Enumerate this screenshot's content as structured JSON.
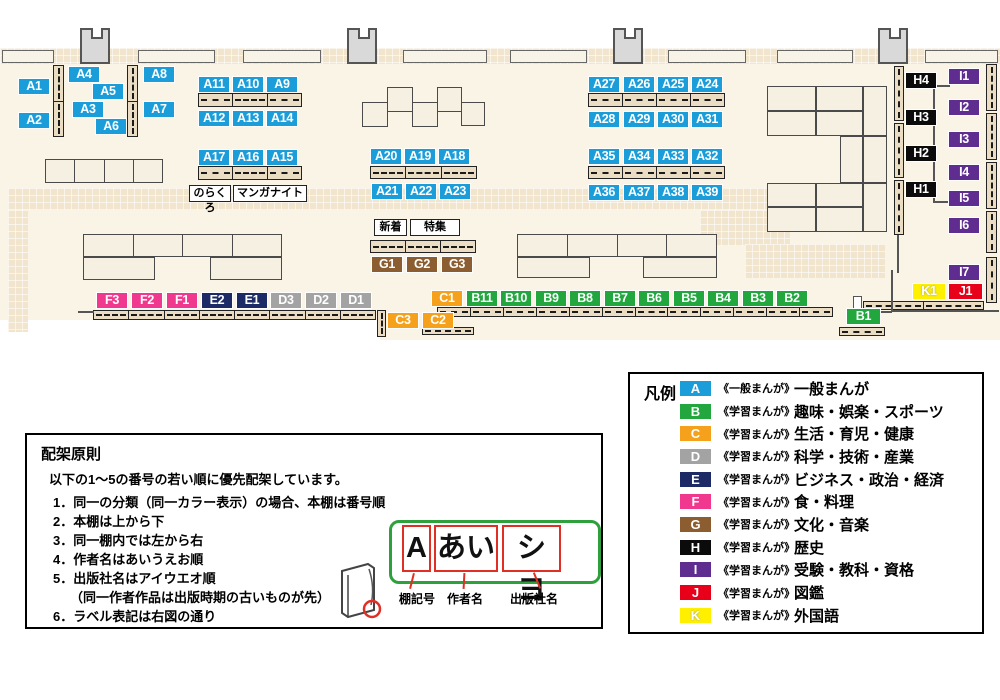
{
  "map": {
    "label_colors": {
      "A": "#1B9DD9",
      "B": "#21A73E",
      "C": "#F5A11C",
      "D": "#A3A3A3",
      "E": "#1C2A65",
      "F": "#F0388E",
      "G": "#8B5D30",
      "H": "#0B0B0B",
      "I": "#5F2C90",
      "J": "#E8001A",
      "K": "#FFF000"
    },
    "shelf_labels": [
      {
        "id": "A1",
        "x": 18,
        "y": 78
      },
      {
        "id": "A2",
        "x": 18,
        "y": 112
      },
      {
        "id": "A4",
        "x": 68,
        "y": 66
      },
      {
        "id": "A3",
        "x": 72,
        "y": 101
      },
      {
        "id": "A5",
        "x": 92,
        "y": 83
      },
      {
        "id": "A6",
        "x": 95,
        "y": 118
      },
      {
        "id": "A8",
        "x": 143,
        "y": 66
      },
      {
        "id": "A7",
        "x": 143,
        "y": 101
      },
      {
        "id": "A11",
        "x": 198,
        "y": 76
      },
      {
        "id": "A10",
        "x": 232,
        "y": 76
      },
      {
        "id": "A9",
        "x": 266,
        "y": 76
      },
      {
        "id": "A12",
        "x": 198,
        "y": 110
      },
      {
        "id": "A13",
        "x": 232,
        "y": 110
      },
      {
        "id": "A14",
        "x": 266,
        "y": 110
      },
      {
        "id": "A17",
        "x": 198,
        "y": 149
      },
      {
        "id": "A16",
        "x": 232,
        "y": 149
      },
      {
        "id": "A15",
        "x": 266,
        "y": 149
      },
      {
        "id": "A20",
        "x": 370,
        "y": 148
      },
      {
        "id": "A19",
        "x": 404,
        "y": 148
      },
      {
        "id": "A18",
        "x": 438,
        "y": 148
      },
      {
        "id": "A21",
        "x": 371,
        "y": 183
      },
      {
        "id": "A22",
        "x": 405,
        "y": 183
      },
      {
        "id": "A23",
        "x": 439,
        "y": 183
      },
      {
        "id": "A27",
        "x": 588,
        "y": 76
      },
      {
        "id": "A26",
        "x": 623,
        "y": 76
      },
      {
        "id": "A25",
        "x": 657,
        "y": 76
      },
      {
        "id": "A24",
        "x": 691,
        "y": 76
      },
      {
        "id": "A28",
        "x": 588,
        "y": 111
      },
      {
        "id": "A29",
        "x": 623,
        "y": 111
      },
      {
        "id": "A30",
        "x": 657,
        "y": 111
      },
      {
        "id": "A31",
        "x": 691,
        "y": 111
      },
      {
        "id": "A35",
        "x": 588,
        "y": 148
      },
      {
        "id": "A34",
        "x": 623,
        "y": 148
      },
      {
        "id": "A33",
        "x": 657,
        "y": 148
      },
      {
        "id": "A32",
        "x": 691,
        "y": 148
      },
      {
        "id": "A36",
        "x": 588,
        "y": 184
      },
      {
        "id": "A37",
        "x": 623,
        "y": 184
      },
      {
        "id": "A38",
        "x": 657,
        "y": 184
      },
      {
        "id": "A39",
        "x": 691,
        "y": 184
      },
      {
        "id": "G1",
        "x": 371,
        "y": 256
      },
      {
        "id": "G2",
        "x": 406,
        "y": 256
      },
      {
        "id": "G3",
        "x": 441,
        "y": 256
      },
      {
        "id": "F3",
        "x": 96,
        "y": 292
      },
      {
        "id": "F2",
        "x": 131,
        "y": 292
      },
      {
        "id": "F1",
        "x": 166,
        "y": 292
      },
      {
        "id": "E2",
        "x": 201,
        "y": 292
      },
      {
        "id": "E1",
        "x": 236,
        "y": 292
      },
      {
        "id": "D3",
        "x": 270,
        "y": 292
      },
      {
        "id": "D2",
        "x": 305,
        "y": 292
      },
      {
        "id": "D1",
        "x": 340,
        "y": 292
      },
      {
        "id": "C3",
        "x": 387,
        "y": 312
      },
      {
        "id": "C2",
        "x": 422,
        "y": 312
      },
      {
        "id": "C1",
        "x": 431,
        "y": 290
      },
      {
        "id": "B11",
        "x": 466,
        "y": 290
      },
      {
        "id": "B10",
        "x": 500,
        "y": 290
      },
      {
        "id": "B9",
        "x": 535,
        "y": 290
      },
      {
        "id": "B8",
        "x": 569,
        "y": 290
      },
      {
        "id": "B7",
        "x": 604,
        "y": 290
      },
      {
        "id": "B6",
        "x": 638,
        "y": 290
      },
      {
        "id": "B5",
        "x": 673,
        "y": 290
      },
      {
        "id": "B4",
        "x": 707,
        "y": 290
      },
      {
        "id": "B3",
        "x": 742,
        "y": 290
      },
      {
        "id": "B2",
        "x": 776,
        "y": 290
      },
      {
        "id": "B1",
        "x": 846,
        "y": 308,
        "w": 35
      },
      {
        "id": "H4",
        "x": 905,
        "y": 72
      },
      {
        "id": "H3",
        "x": 905,
        "y": 109
      },
      {
        "id": "H2",
        "x": 905,
        "y": 145
      },
      {
        "id": "H1",
        "x": 905,
        "y": 181
      },
      {
        "id": "I1",
        "x": 948,
        "y": 68
      },
      {
        "id": "I2",
        "x": 948,
        "y": 99
      },
      {
        "id": "I3",
        "x": 948,
        "y": 131
      },
      {
        "id": "I4",
        "x": 948,
        "y": 164
      },
      {
        "id": "I5",
        "x": 948,
        "y": 190
      },
      {
        "id": "I6",
        "x": 948,
        "y": 217
      },
      {
        "id": "I7",
        "x": 948,
        "y": 264
      },
      {
        "id": "K1",
        "x": 912,
        "y": 283,
        "w": 34
      },
      {
        "id": "J1",
        "x": 948,
        "y": 283,
        "w": 35
      }
    ],
    "annotations": [
      {
        "text": "のらくろ",
        "x": 189,
        "y": 185,
        "w": 42
      },
      {
        "text": "マンガナイト",
        "x": 233,
        "y": 185,
        "w": 74
      },
      {
        "text": "新着",
        "x": 374,
        "y": 219,
        "w": 33
      },
      {
        "text": "特集",
        "x": 410,
        "y": 219,
        "w": 50
      }
    ]
  },
  "principles": {
    "title": "配架原則",
    "intro": "以下の1～5の番号の若い順に優先配架しています。",
    "items": [
      "同一の分類（同一カラー表示）の場合、本棚は番号順",
      "本棚は上から下",
      "同一棚内では左から右",
      "作者名はあいうえお順",
      "出版社名はアイウエオ順",
      "ラベル表記は右図の通り"
    ],
    "note": "（同一作者作品は出版時期の古いものが先）",
    "note_after": 5
  },
  "label_diagram": {
    "segments": [
      "A",
      "あい",
      "シヨ"
    ],
    "captions": [
      "棚記号",
      "作者名",
      "出版社名"
    ]
  },
  "legend": {
    "title": "凡例",
    "rows": [
      {
        "letter": "A",
        "color": "#1B9DD9",
        "type": "《一般まんが》",
        "category": "一般まんが"
      },
      {
        "letter": "B",
        "color": "#21A73E",
        "type": "《学習まんが》",
        "category": "趣味・娯楽・スポーツ"
      },
      {
        "letter": "C",
        "color": "#F5A11C",
        "type": "《学習まんが》",
        "category": "生活・育児・健康"
      },
      {
        "letter": "D",
        "color": "#A3A3A3",
        "type": "《学習まんが》",
        "category": "科学・技術・産業"
      },
      {
        "letter": "E",
        "color": "#1C2A65",
        "type": "《学習まんが》",
        "category": "ビジネス・政治・経済"
      },
      {
        "letter": "F",
        "color": "#F0388E",
        "type": "《学習まんが》",
        "category": "食・料理"
      },
      {
        "letter": "G",
        "color": "#8B5D30",
        "type": "《学習まんが》",
        "category": "文化・音楽"
      },
      {
        "letter": "H",
        "color": "#0B0B0B",
        "type": "《学習まんが》",
        "category": "歴史"
      },
      {
        "letter": "I",
        "color": "#5F2C90",
        "type": "《学習まんが》",
        "category": "受験・教科・資格"
      },
      {
        "letter": "J",
        "color": "#E8001A",
        "type": "《学習まんが》",
        "category": "図鑑"
      },
      {
        "letter": "K",
        "color": "#FFF000",
        "type": "《学習まんが》",
        "category": "外国語"
      }
    ]
  }
}
